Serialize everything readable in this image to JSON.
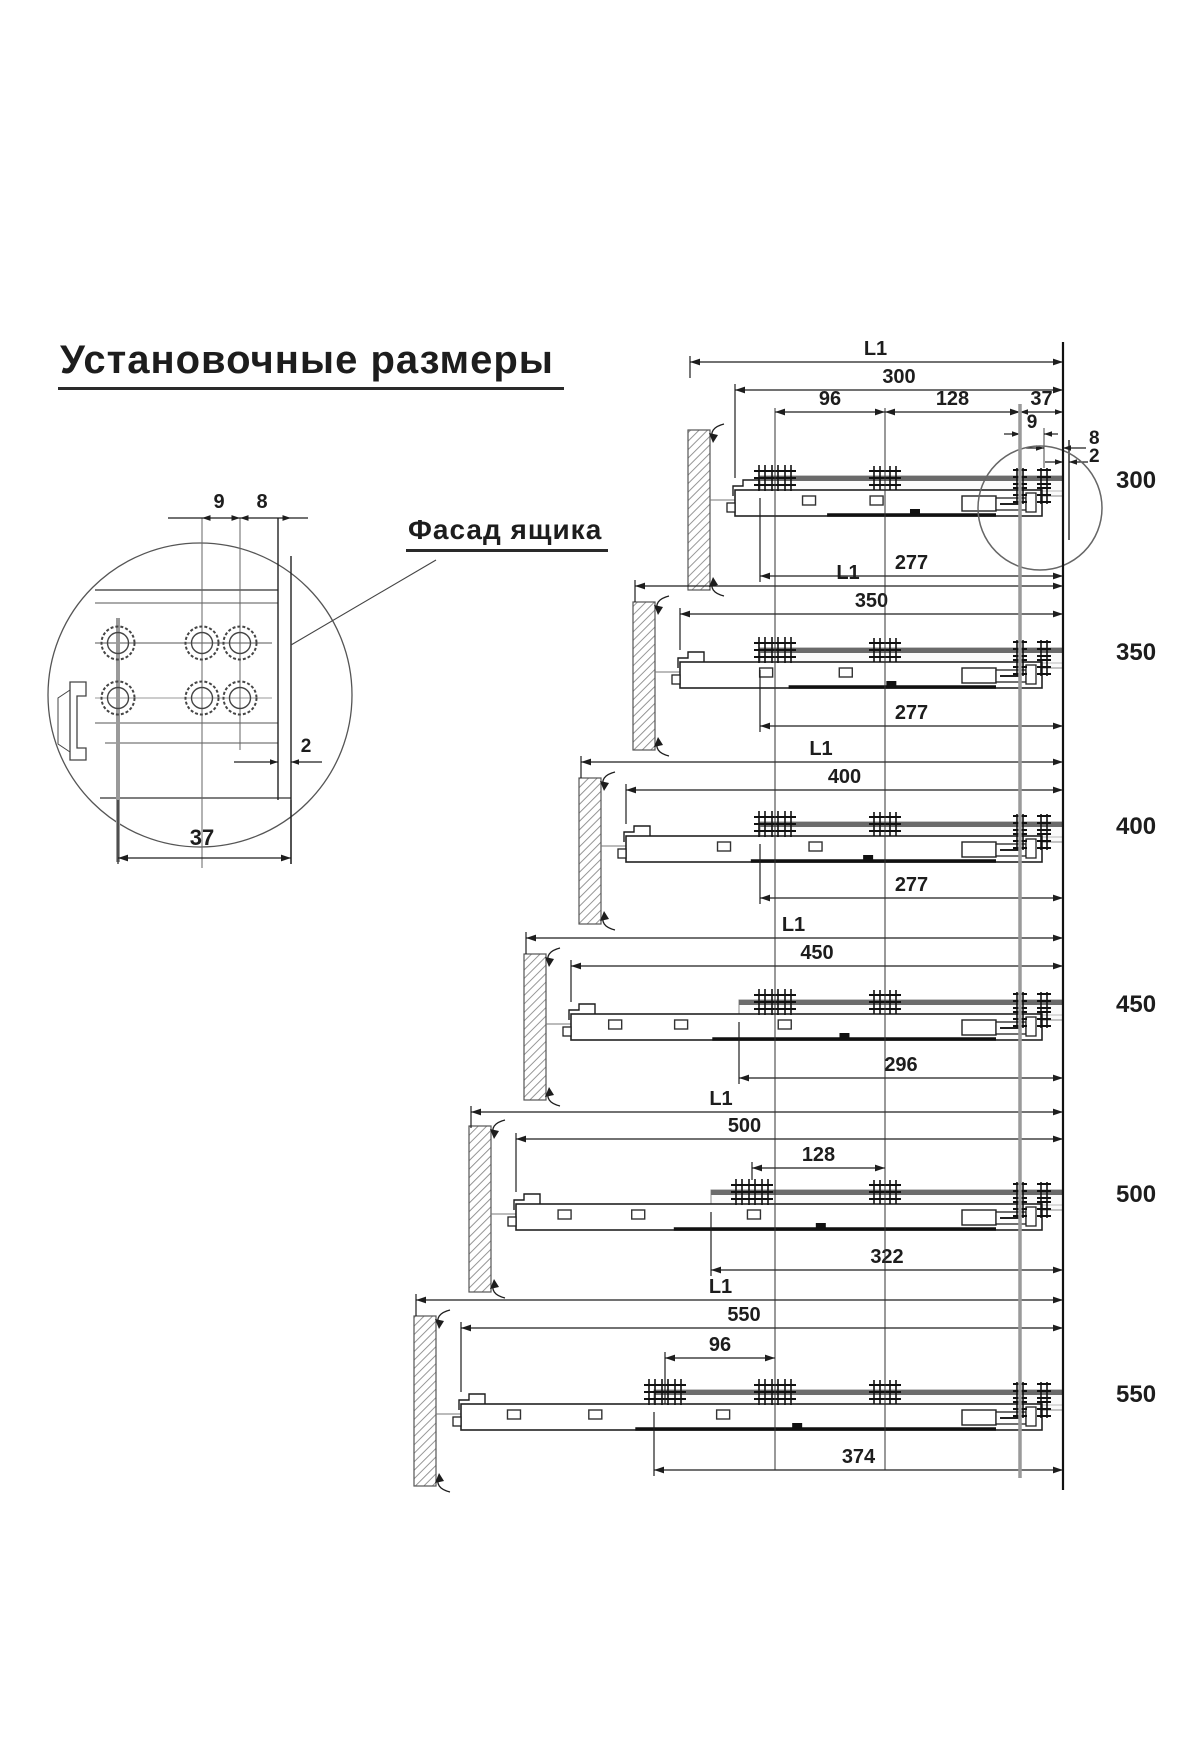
{
  "title": {
    "text": "Установочные размеры"
  },
  "detail_view": {
    "label": "Фасад ящика",
    "dims": {
      "hole_pitch": "9",
      "front_offset": "8",
      "edge_gap": "2",
      "width": "37"
    }
  },
  "slides": {
    "rows": [
      {
        "size_label": "300",
        "l1": "L1",
        "length": "300",
        "bottom": "277",
        "dim_96": "96",
        "dim_128": "128",
        "dim_37": "37",
        "dim_9": "9",
        "dim_8": "8",
        "dim_2": "2"
      },
      {
        "size_label": "350",
        "l1": "L1",
        "length": "350",
        "bottom": "277"
      },
      {
        "size_label": "400",
        "l1": "L1",
        "length": "400",
        "bottom": "277"
      },
      {
        "size_label": "450",
        "l1": "L1",
        "length": "450",
        "bottom": "296"
      },
      {
        "size_label": "500",
        "l1": "L1",
        "length": "500",
        "bottom": "322",
        "dim_128": "128"
      },
      {
        "size_label": "550",
        "l1": "L1",
        "length": "550",
        "bottom": "374",
        "dim_96": "96"
      }
    ]
  },
  "colors": {
    "line": "#1d1d1d",
    "rail_band": "#6a6a6a",
    "ref_line": "#9a9a9a",
    "background": "#ffffff"
  }
}
